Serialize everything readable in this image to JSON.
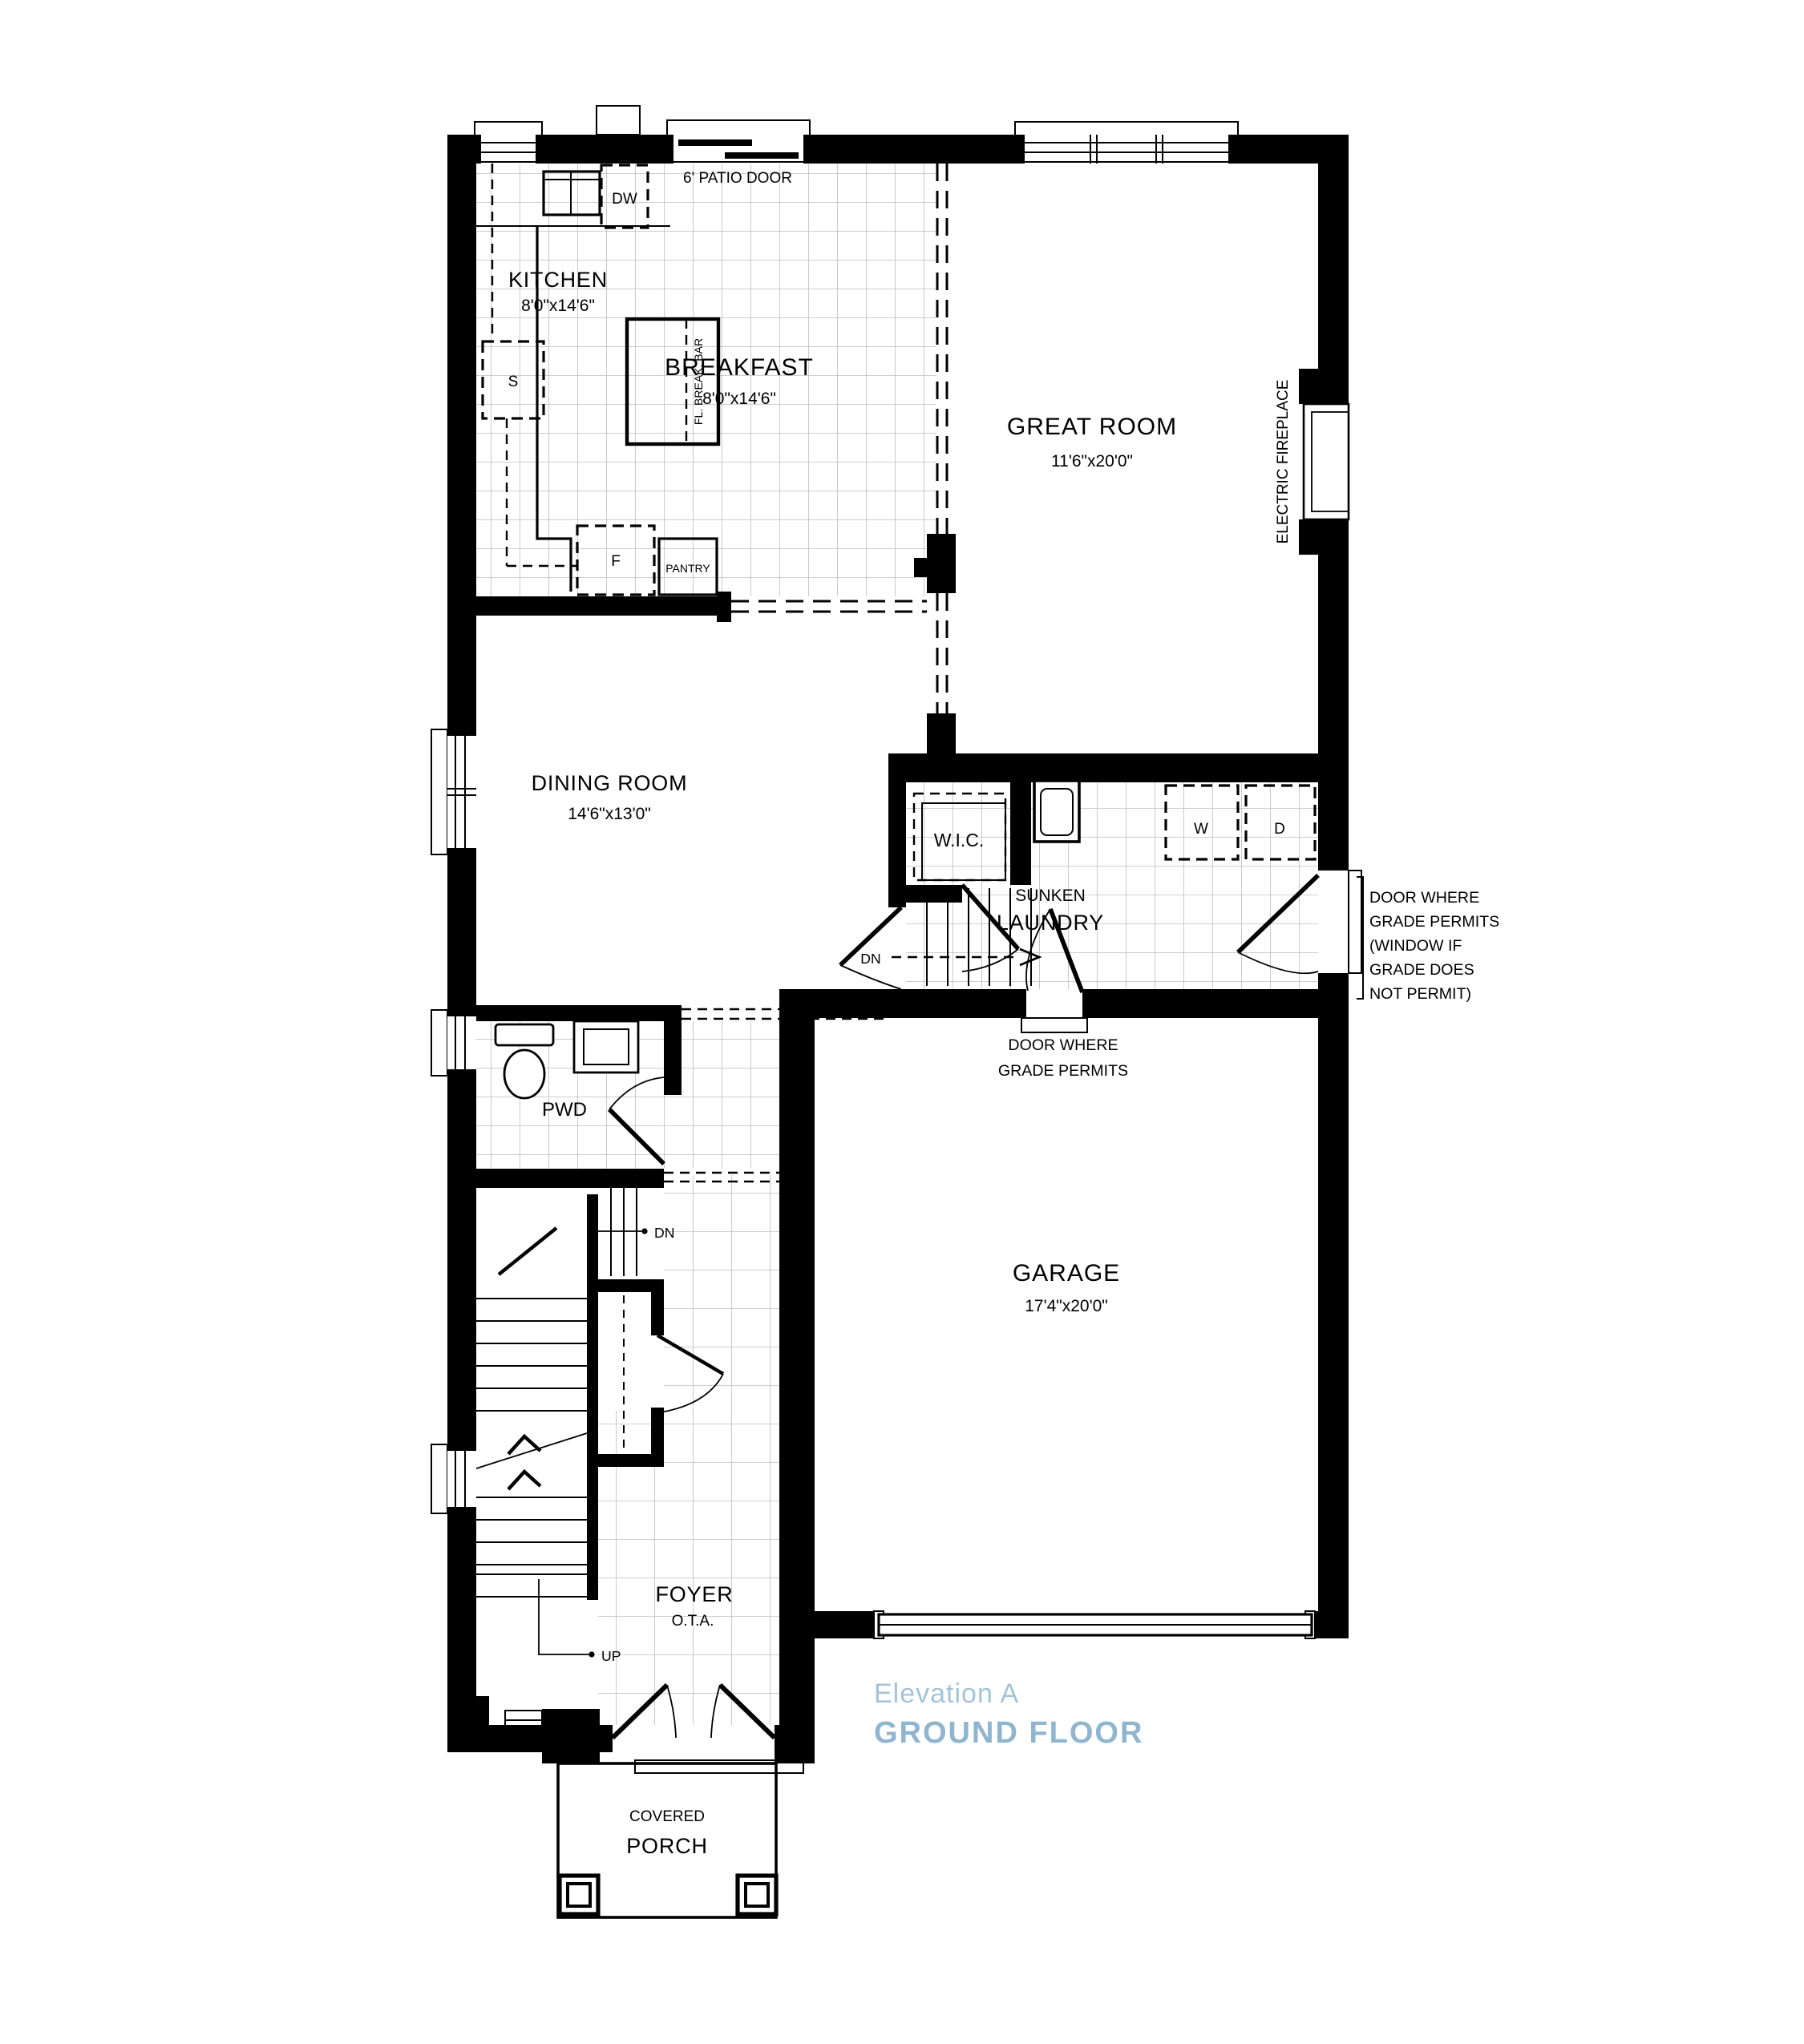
{
  "meta": {
    "drawing_type": "residential ground floor plan"
  },
  "colors": {
    "wall": "#000000",
    "grid": "#bdbdbd",
    "accent_light": "#a5c3d8",
    "accent": "#8fb5cf"
  },
  "rooms": {
    "kitchen": {
      "name": "KITCHEN",
      "dims": "8'0\"x14'6\""
    },
    "breakfast": {
      "name": "BREAKFAST",
      "dims": "8'0\"x14'6\""
    },
    "great_room": {
      "name": "GREAT ROOM",
      "dims": "11'6\"x20'0\""
    },
    "dining": {
      "name": "DINING ROOM",
      "dims": "14'6\"x13'0\""
    },
    "garage": {
      "name": "GARAGE",
      "dims": "17'4\"x20'0\""
    },
    "foyer": {
      "name": "FOYER",
      "sub": "O.T.A."
    },
    "laundry": {
      "line1": "SUNKEN",
      "line2": "LAUNDRY"
    },
    "wic": {
      "name": "W.I.C."
    },
    "pwd": {
      "name": "PWD"
    },
    "porch": {
      "line1": "COVERED",
      "line2": "PORCH"
    }
  },
  "fixtures": {
    "dishwasher": "DW",
    "sink": "S",
    "fridge": "F",
    "pantry": "PANTRY",
    "break_bar": "FL. BREAK. BAR",
    "washer": "W",
    "dryer": "D",
    "patio_door": "6' PATIO DOOR",
    "fireplace": "ELECTRIC FIREPLACE",
    "dn": "DN",
    "up": "UP"
  },
  "annotations": {
    "right_door": [
      "DOOR WHERE",
      "GRADE PERMITS",
      "(WINDOW IF",
      "GRADE DOES",
      "NOT PERMIT)"
    ],
    "bottom_door": [
      "DOOR WHERE",
      "GRADE PERMITS"
    ]
  },
  "footer": {
    "elevation": "Elevation A",
    "floor": "GROUND FLOOR"
  }
}
